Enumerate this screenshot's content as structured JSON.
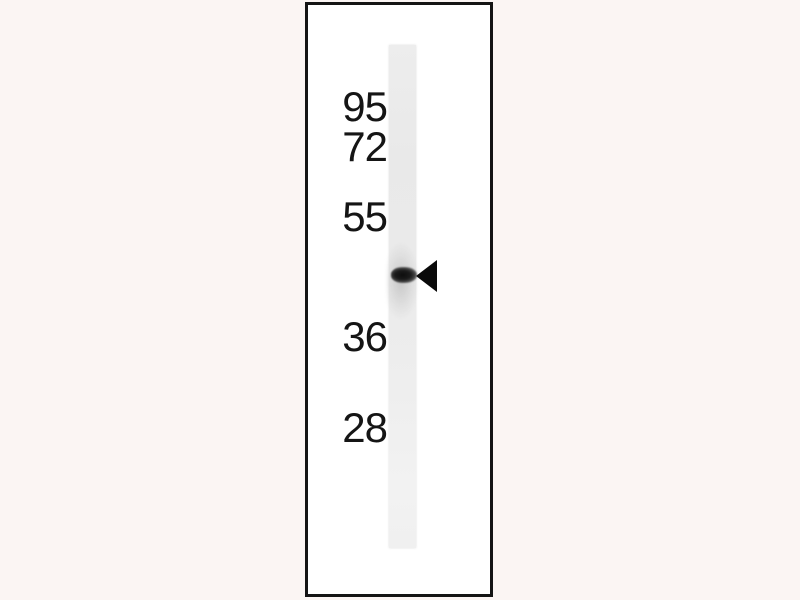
{
  "figure": {
    "kind": "western blot",
    "marker_labels": [
      "95",
      "72",
      "55",
      "36",
      "28"
    ],
    "band": {
      "count": 1,
      "position": "between the 55 and 36 marker labels"
    },
    "arrow_icon": {
      "name": "left-arrowhead-icon",
      "glyph": "◀"
    },
    "colors": {
      "page_background": "#fbf5f3",
      "frame_border": "#141414",
      "frame_background": "#ffffff",
      "lane": "#ebebeb",
      "band": "#121212",
      "arrow": "#0a0a0a",
      "label_text": "#151515"
    }
  }
}
